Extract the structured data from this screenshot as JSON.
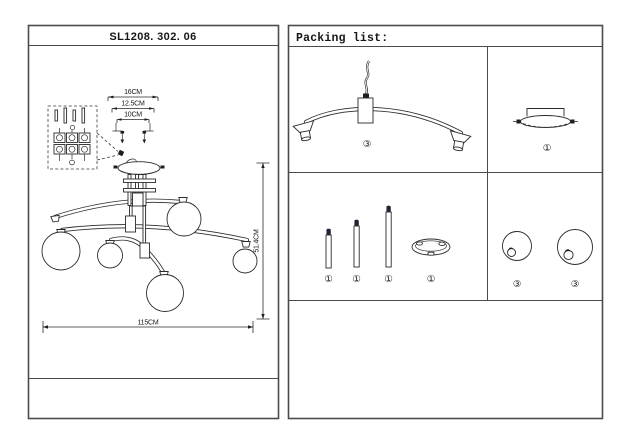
{
  "left_panel": {
    "title": "SL1208. 302. 06",
    "canopy_dims": {
      "outer": "16CM",
      "mid": "12.5CM",
      "inner": "10CM"
    },
    "height_dim": "51.4CM",
    "width_dim": "115CM"
  },
  "packing_list": {
    "title": "Packing list:",
    "arm_assembly_qty": "③",
    "canopy_qty": "①",
    "rod_short_qty": "①",
    "rod_medium_qty": "①",
    "rod_long_qty": "①",
    "ring_qty": "①",
    "globe_small_qty": "③",
    "globe_large_qty": "③"
  }
}
